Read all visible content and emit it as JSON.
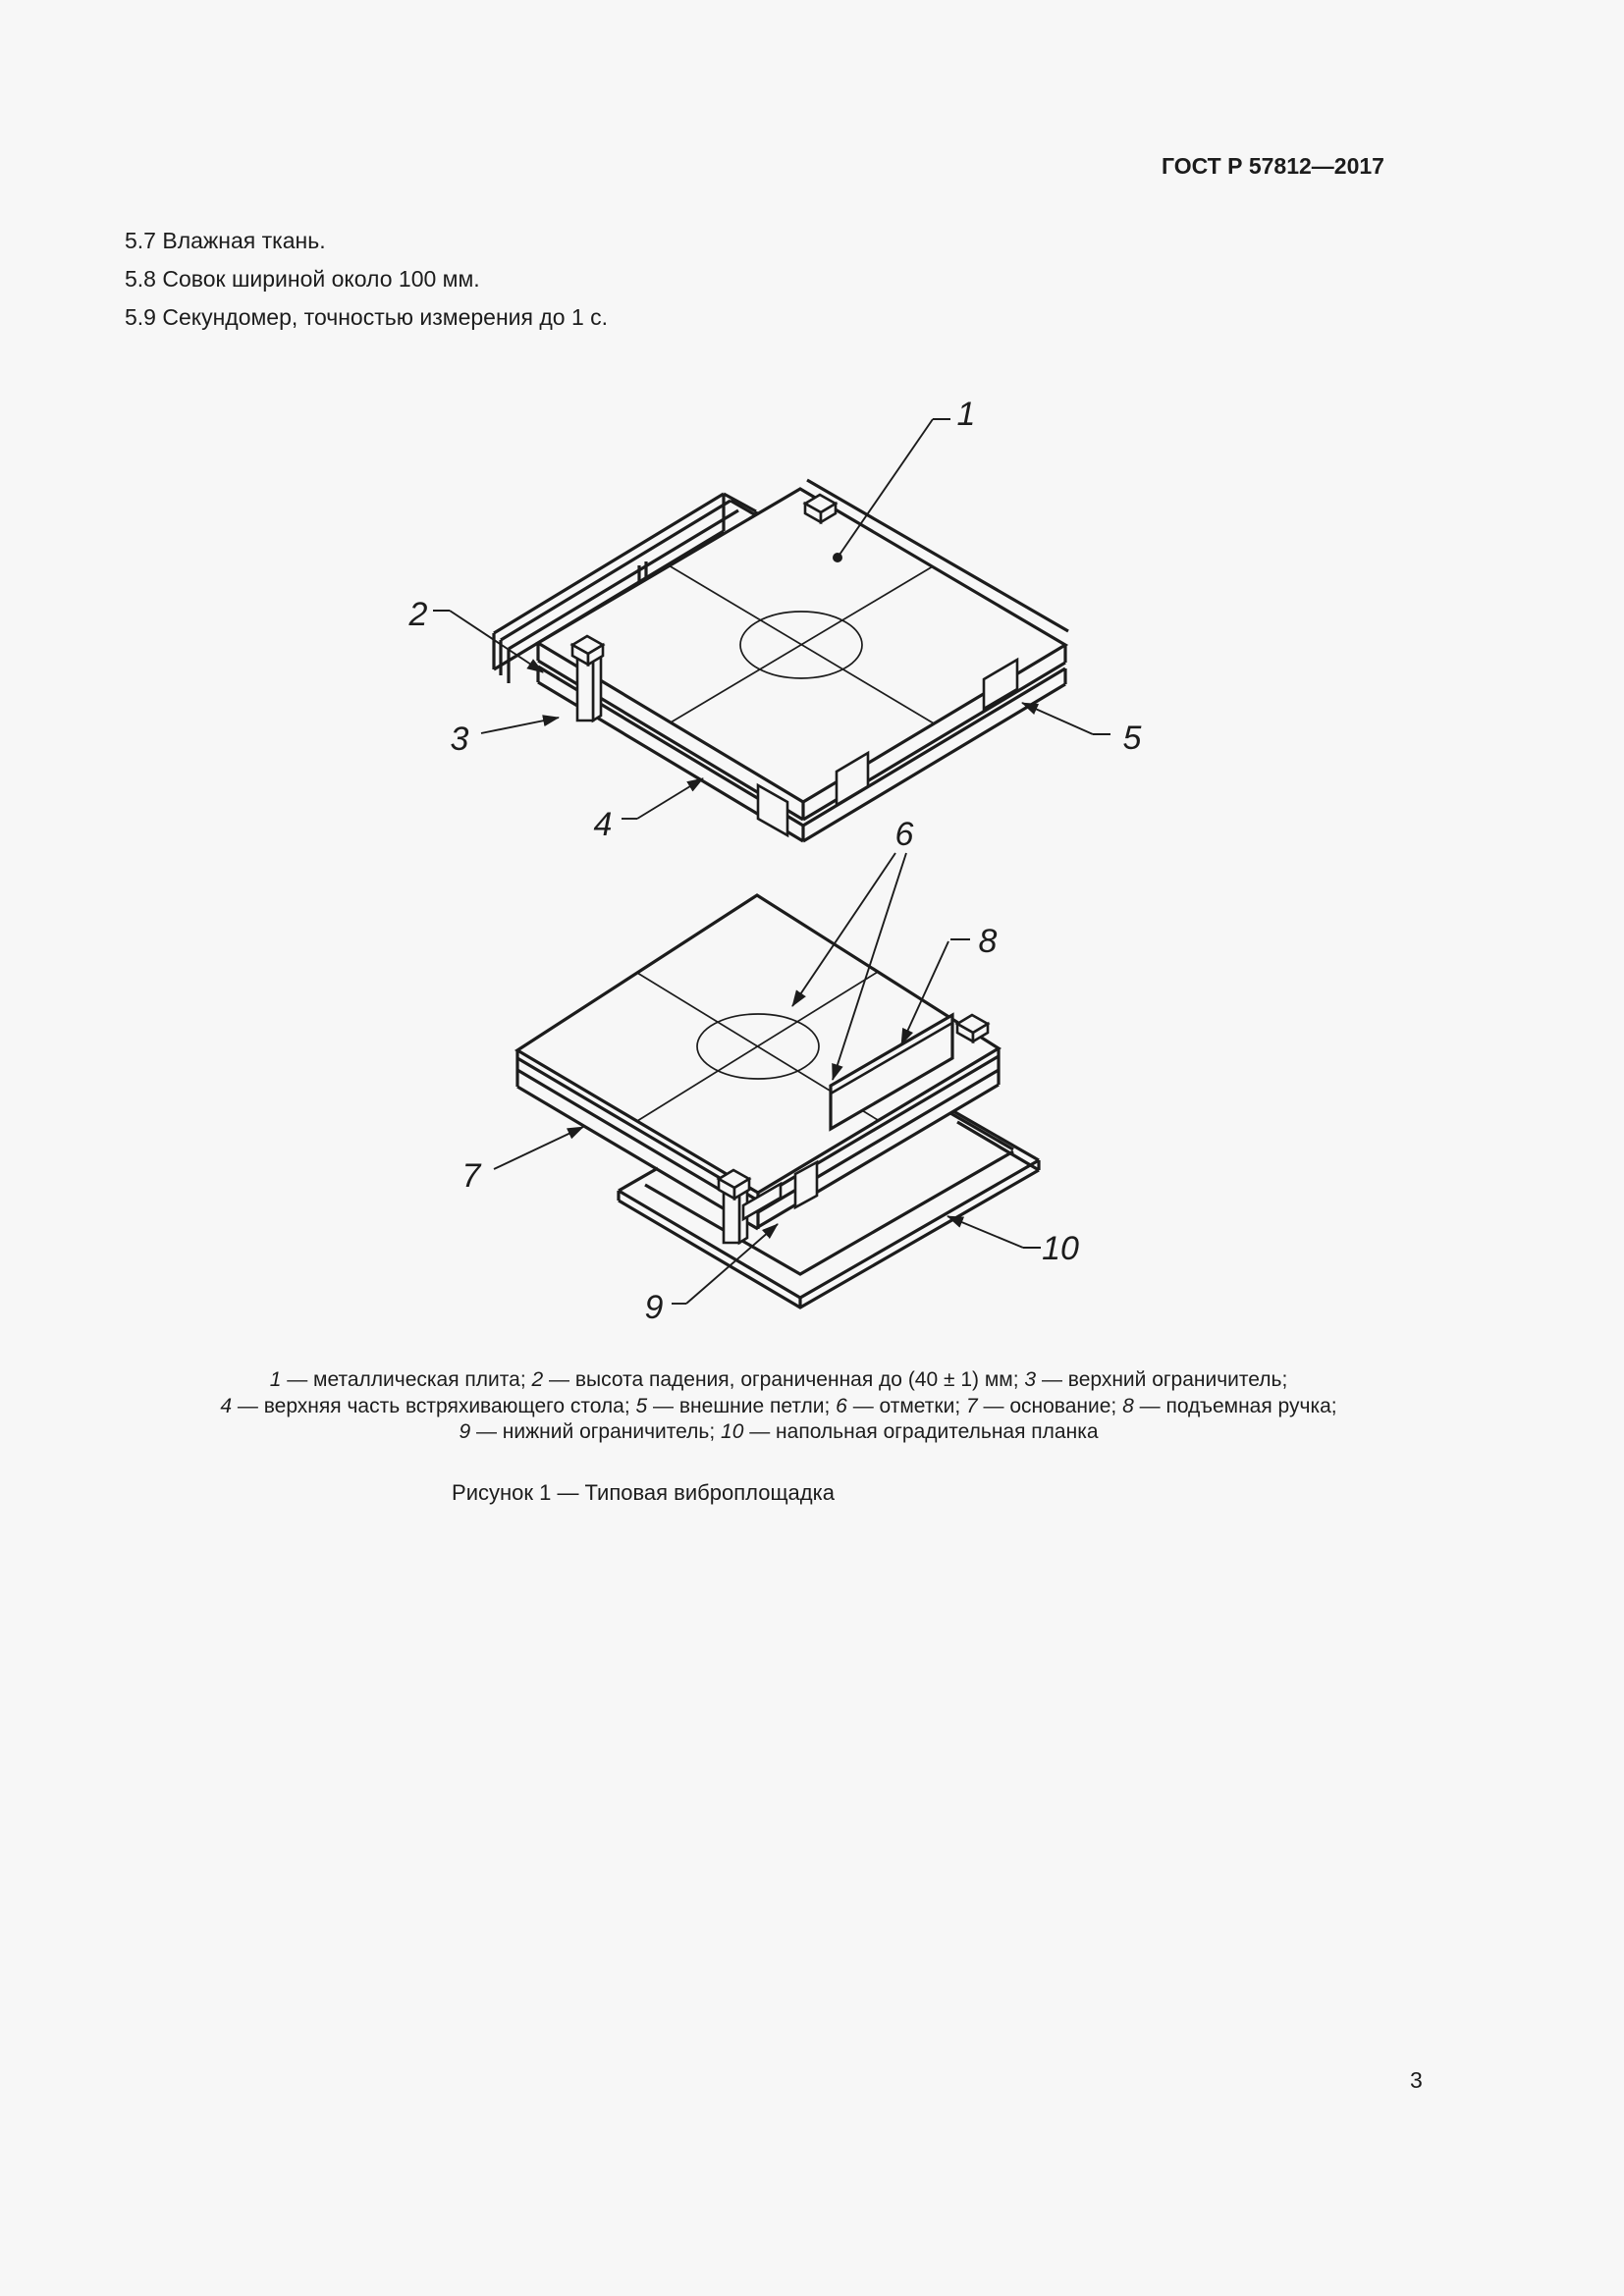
{
  "page": {
    "background": "#f7f7f7",
    "ink_color": "#1c1c1c"
  },
  "header": {
    "standard_code": "ГОСТ Р 57812—2017"
  },
  "body": {
    "paragraphs": [
      "5.7 Влажная ткань.",
      "5.8 Совок шириной около 100 мм.",
      "5.9 Секундомер, точностью измерения до 1 с."
    ]
  },
  "figure": {
    "caption": "Рисунок 1 — Типовая виброплощадка",
    "callouts": {
      "c1": "1",
      "c2": "2",
      "c3": "3",
      "c4": "4",
      "c5": "5",
      "c6": "6",
      "c7": "7",
      "c8": "8",
      "c9": "9",
      "c10": "10"
    },
    "legend_lines": [
      [
        {
          "i": "1"
        },
        {
          "t": " — металлическая плита; "
        },
        {
          "i": "2"
        },
        {
          "t": " — высота падения, ограниченная до (40 ± 1) мм; "
        },
        {
          "i": "3"
        },
        {
          "t": " — верхний ограничитель;"
        }
      ],
      [
        {
          "i": "4"
        },
        {
          "t": " — верхняя часть встряхивающего стола; "
        },
        {
          "i": "5"
        },
        {
          "t": " — внешние петли; "
        },
        {
          "i": "6"
        },
        {
          "t": " — отметки; "
        },
        {
          "i": "7"
        },
        {
          "t": " — основание; "
        },
        {
          "i": "8"
        },
        {
          "t": " — подъемная ручка;"
        }
      ],
      [
        {
          "i": "9"
        },
        {
          "t": " — нижний ограничитель; "
        },
        {
          "i": "10"
        },
        {
          "t": " — напольная оградительная планка"
        }
      ]
    ]
  },
  "footer": {
    "page_number": "3"
  }
}
